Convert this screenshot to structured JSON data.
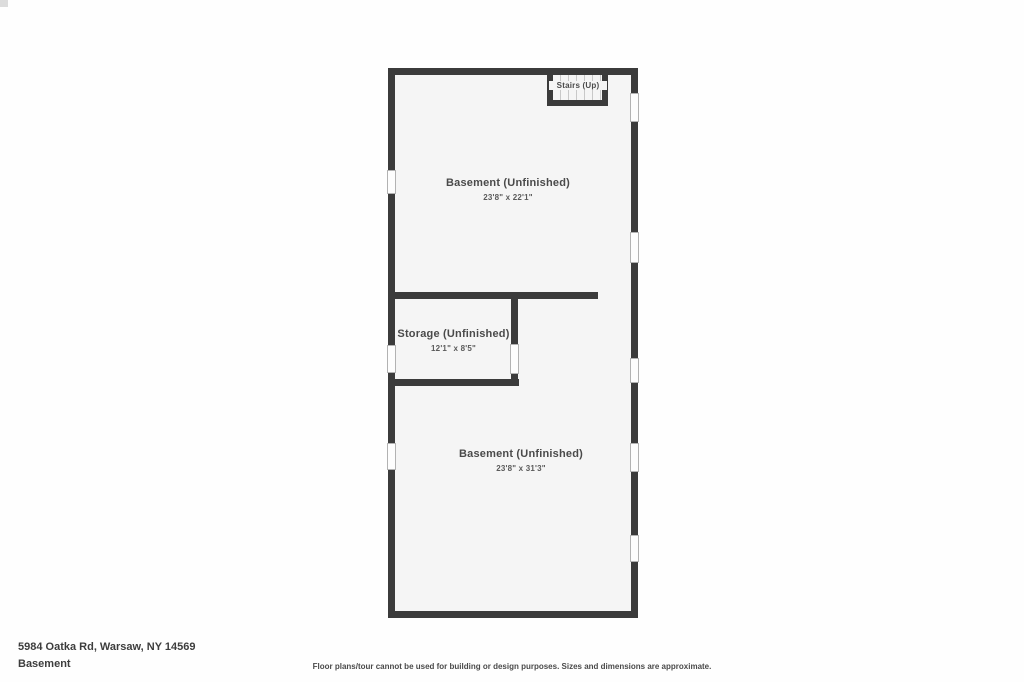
{
  "plan": {
    "stairs": {
      "label": "Stairs (Up)"
    },
    "rooms": [
      {
        "name": "Basement (Unfinished)",
        "dims": "23'8\" x 22'1\""
      },
      {
        "name": "Storage (Unfinished)",
        "dims": "12'1\" x 8'5\""
      },
      {
        "name": "Basement (Unfinished)",
        "dims": "23'8\" x 31'3\""
      }
    ]
  },
  "footer": {
    "address": "5984 Oatka Rd, Warsaw, NY 14569",
    "level": "Basement",
    "disclaimer": "Floor plans/tour cannot be used for building or design purposes. Sizes and dimensions are approximate."
  },
  "colors": {
    "wall": "#3b3b3b",
    "floor": "#f5f5f5",
    "window_border": "#b2b2b2",
    "tread": "#c8c8c8",
    "label_text": "#4a4a4a",
    "footer_text": "#3d3d3d"
  }
}
